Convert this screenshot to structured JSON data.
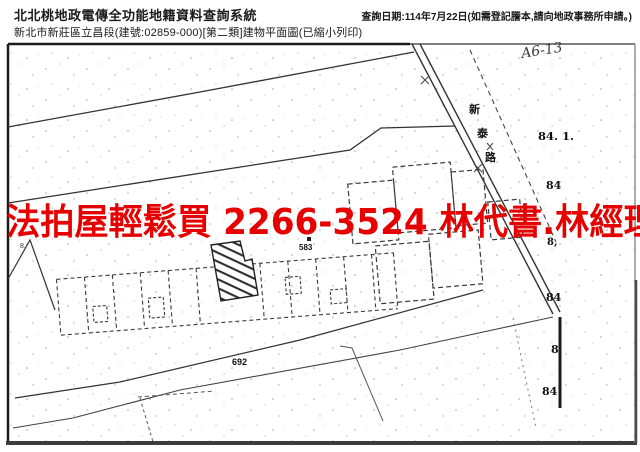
{
  "header": {
    "system_title": "北北桃地政電傳全功能地籍資料查詢系統",
    "document_subtitle": "新北市新莊區立昌段(建號:02859-000)[第二類]建物平面圖(已縮小列印)",
    "query_date_note": "查詢日期:114年7月22日(如需登記謄本,請向地政事務所申請。)"
  },
  "overlay": {
    "ad_text": "法拍屋輕鬆買 2266-3524 林代書.林經理",
    "color": "#e60000"
  },
  "map": {
    "handwritten_note": "A6-13",
    "road_name": "新泰路",
    "road_name_chars": {
      "c1": "新",
      "c2": "泰",
      "c3": "路"
    },
    "labels": {
      "lot_84_1": "84. 1.",
      "lot_84_a": "84",
      "lot_8_comma": "8,",
      "lot_84_b": "84",
      "lot_8": "8",
      "lot_84_c": "84",
      "bldg_583": "583",
      "lot_692": "692",
      "lot_8_left": "8."
    },
    "colors": {
      "ink": "#222222",
      "border": "#1c1c1c"
    }
  }
}
